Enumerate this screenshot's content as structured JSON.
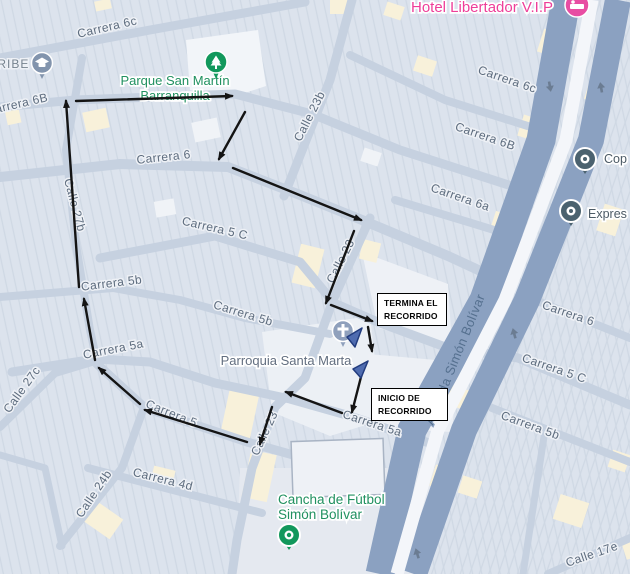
{
  "map": {
    "width": 630,
    "height": 574,
    "palette": {
      "bg_blocks": "#dce3ed",
      "block_stripe": "#cfd8e4",
      "street": "#c6d1e0",
      "avenue": "#8ba1c1",
      "avenue_median": "#f4f6fa",
      "street_label": "#5d6c7e",
      "avenue_label": "#55708f",
      "poi_green": "#219160",
      "poi_gray": "#636f80",
      "poi_pink": "#ee3e99",
      "poi_dark": "#4d5b66",
      "pin_green": "#12985c",
      "pin_slate": "#8294ad",
      "pin_church": "#8fa0bc",
      "pin_dark": "#4b626f",
      "pin_pink": "#e84da3",
      "route_color": "#141414",
      "marker_blue": "#4f6cb0",
      "marker_blue_dark": "#223c7e",
      "oneway": "#6b7c92"
    },
    "streets": [
      {
        "name": "carrera-6c",
        "w": 9,
        "pts": [
          [
            0,
            58
          ],
          [
            150,
            30
          ],
          [
            305,
            2
          ]
        ]
      },
      {
        "name": "carrera-6b",
        "w": 9,
        "pts": [
          [
            0,
            107
          ],
          [
            75,
            100
          ],
          [
            235,
            94
          ],
          [
            312,
            114
          ],
          [
            400,
            150
          ],
          [
            518,
            188
          ]
        ]
      },
      {
        "name": "carrera-6",
        "w": 10,
        "pts": [
          [
            0,
            177
          ],
          [
            120,
            164
          ],
          [
            228,
            167
          ],
          [
            300,
            195
          ],
          [
            362,
            220
          ],
          [
            448,
            256
          ],
          [
            500,
            280
          ]
        ]
      },
      {
        "name": "carrera-5c",
        "w": 9,
        "pts": [
          [
            100,
            258
          ],
          [
            215,
            236
          ],
          [
            300,
            262
          ],
          [
            334,
            303
          ],
          [
            380,
            323
          ],
          [
            448,
            348
          ],
          [
            518,
            358
          ],
          [
            630,
            405
          ]
        ]
      },
      {
        "name": "carrera-5b",
        "w": 8,
        "pts": [
          [
            0,
            297
          ],
          [
            113,
            288
          ],
          [
            180,
            300
          ],
          [
            245,
            318
          ],
          [
            330,
            334
          ]
        ]
      },
      {
        "name": "carrera-5a",
        "w": 9,
        "pts": [
          [
            12,
            372
          ],
          [
            95,
            359
          ],
          [
            150,
            362
          ],
          [
            215,
            383
          ],
          [
            290,
            399
          ],
          [
            350,
            416
          ],
          [
            432,
            444
          ]
        ]
      },
      {
        "name": "carrera-5",
        "w": 9,
        "pts": [
          [
            97,
            364
          ],
          [
            145,
            408
          ],
          [
            247,
            442
          ],
          [
            318,
            462
          ]
        ]
      },
      {
        "name": "carrera-4d",
        "w": 8,
        "pts": [
          [
            88,
            468
          ],
          [
            200,
            497
          ],
          [
            262,
            513
          ]
        ]
      },
      {
        "name": "calle-27b",
        "w": 8,
        "pts": [
          [
            82,
            58
          ],
          [
            66,
            150
          ],
          [
            76,
            245
          ],
          [
            90,
            330
          ],
          [
            97,
            362
          ]
        ]
      },
      {
        "name": "calle-27c",
        "w": 8,
        "pts": [
          [
            0,
            427
          ],
          [
            55,
            373
          ],
          [
            95,
            361
          ]
        ]
      },
      {
        "name": "calle-24b",
        "w": 8,
        "pts": [
          [
            60,
            546
          ],
          [
            122,
            468
          ],
          [
            143,
            410
          ]
        ]
      },
      {
        "name": "calle-24b-curve",
        "w": 7,
        "pts": [
          [
            0,
            455
          ],
          [
            45,
            468
          ],
          [
            62,
            546
          ]
        ]
      },
      {
        "name": "calle-23",
        "w": 9,
        "pts": [
          [
            370,
            218
          ],
          [
            333,
            300
          ],
          [
            305,
            378
          ],
          [
            275,
            407
          ],
          [
            252,
            468
          ],
          [
            237,
            540
          ],
          [
            232,
            574
          ]
        ]
      },
      {
        "name": "calle-23b",
        "w": 9,
        "pts": [
          [
            284,
            196
          ],
          [
            330,
            80
          ],
          [
            352,
            0
          ]
        ]
      },
      {
        "name": "carrera-6c-east",
        "w": 8,
        "pts": [
          [
            350,
            55
          ],
          [
            445,
            100
          ],
          [
            534,
            128
          ]
        ]
      },
      {
        "name": "carrera-6a",
        "w": 8,
        "pts": [
          [
            395,
            200
          ],
          [
            468,
            222
          ],
          [
            520,
            238
          ]
        ]
      },
      {
        "name": "carrera-6-east",
        "w": 8,
        "pts": [
          [
            535,
            300
          ],
          [
            630,
            338
          ]
        ]
      },
      {
        "name": "carrera-5b-east",
        "w": 8,
        "pts": [
          [
            492,
            408
          ],
          [
            630,
            462
          ]
        ]
      },
      {
        "name": "calle-17e",
        "w": 8,
        "pts": [
          [
            548,
            574
          ],
          [
            630,
            538
          ]
        ]
      },
      {
        "name": "calle-east",
        "w": 7,
        "pts": [
          [
            545,
            430
          ],
          [
            523,
            574
          ]
        ]
      }
    ],
    "avenue": {
      "name": "avenida-simon-bolivar",
      "carriageway_west": [
        [
          566,
          0
        ],
        [
          541,
          140
        ],
        [
          484,
          300
        ],
        [
          412,
          430
        ],
        [
          380,
          574
        ]
      ],
      "carriageway_east": [
        [
          618,
          0
        ],
        [
          591,
          140
        ],
        [
          527,
          300
        ],
        [
          464,
          430
        ],
        [
          414,
          574
        ]
      ],
      "median": [
        [
          592,
          0
        ],
        [
          566,
          140
        ],
        [
          505,
          300
        ],
        [
          438,
          430
        ],
        [
          397,
          574
        ]
      ]
    },
    "oneway_arrows": [
      [
        550,
        87,
        170
      ],
      [
        601,
        87,
        -10
      ],
      [
        514,
        333,
        -15
      ],
      [
        417,
        553,
        -17
      ]
    ],
    "plazas": [
      {
        "name": "park-area",
        "points": "186,40 258,30 266,86 230,98 190,90",
        "fill": "#f2f5f9"
      },
      {
        "name": "church-plaza",
        "points": "262,332 370,316 382,420 330,436 272,412",
        "fill": "#ecf0f5"
      },
      {
        "name": "block-termina",
        "points": "362,252 448,284 452,348 378,328",
        "fill": "#eef1f6"
      },
      {
        "name": "block-inicio",
        "points": "368,354 458,362 452,432 372,428",
        "fill": "#edf0f5"
      },
      {
        "name": "cancha-field",
        "points": "240,468 436,468 420,574 236,574",
        "fill": "#e5e9f0"
      }
    ],
    "big_building": {
      "x": 292,
      "y": 440,
      "w": 92,
      "h": 56,
      "rot": -2,
      "fill": "#eef1f6",
      "stroke": "#a9b4c4"
    },
    "cream_blocks": [
      [
        84,
        110,
        24,
        20,
        -12
      ],
      [
        6,
        108,
        14,
        16,
        -12
      ],
      [
        330,
        0,
        22,
        14,
        0
      ],
      [
        296,
        246,
        24,
        40,
        14
      ],
      [
        361,
        241,
        18,
        20,
        14
      ],
      [
        225,
        386,
        30,
        54,
        12
      ],
      [
        246,
        452,
        26,
        48,
        12
      ],
      [
        88,
        498,
        24,
        40,
        -55
      ],
      [
        152,
        468,
        22,
        16,
        14
      ],
      [
        385,
        4,
        18,
        14,
        18
      ],
      [
        415,
        58,
        20,
        16,
        18
      ],
      [
        95,
        0,
        16,
        10,
        -12
      ],
      [
        540,
        32,
        26,
        24,
        18
      ],
      [
        586,
        86,
        18,
        16,
        18
      ],
      [
        520,
        118,
        26,
        22,
        18
      ],
      [
        600,
        206,
        20,
        28,
        18
      ],
      [
        492,
        214,
        24,
        22,
        18
      ],
      [
        466,
        308,
        22,
        20,
        18
      ],
      [
        448,
        388,
        24,
        20,
        18
      ],
      [
        432,
        468,
        26,
        22,
        18
      ],
      [
        556,
        498,
        30,
        26,
        18
      ],
      [
        610,
        452,
        18,
        18,
        18
      ],
      [
        624,
        542,
        14,
        16,
        -18
      ],
      [
        460,
        478,
        20,
        18,
        18
      ]
    ],
    "white_blocks": [
      [
        193,
        120,
        26,
        20,
        -12
      ],
      [
        155,
        200,
        20,
        16,
        -10
      ],
      [
        362,
        150,
        18,
        14,
        18
      ]
    ],
    "street_labels": [
      {
        "text": "Carrera 6c",
        "x": 108,
        "y": 31,
        "rot": -13
      },
      {
        "text": "CARIBE",
        "x": 4,
        "y": 68,
        "rot": 0,
        "color": "#76838f",
        "spacing": 1
      },
      {
        "text": "Carrera 6B",
        "x": 18,
        "y": 108,
        "rot": -13
      },
      {
        "text": "Carrera 6",
        "x": 164,
        "y": 161,
        "rot": -6
      },
      {
        "text": "Calle 27b",
        "x": 71,
        "y": 206,
        "rot": 75
      },
      {
        "text": "Carrera 5 C",
        "x": 214,
        "y": 232,
        "rot": 13
      },
      {
        "text": "Carrera 5b",
        "x": 112,
        "y": 287,
        "rot": -7
      },
      {
        "text": "Carrera 5b",
        "x": 242,
        "y": 317,
        "rot": 17
      },
      {
        "text": "Carrera 5a",
        "x": 114,
        "y": 353,
        "rot": -11
      },
      {
        "text": "Calle 27c",
        "x": 25,
        "y": 392,
        "rot": -54
      },
      {
        "text": "Carrera 5",
        "x": 170,
        "y": 417,
        "rot": 22
      },
      {
        "text": "Carrera 5a",
        "x": 371,
        "y": 427,
        "rot": 18
      },
      {
        "text": "Calle 24b",
        "x": 97,
        "y": 496,
        "rot": -56
      },
      {
        "text": "Carrera 4d",
        "x": 162,
        "y": 483,
        "rot": 14
      },
      {
        "text": "Calle 23",
        "x": 268,
        "y": 435,
        "rot": -65
      },
      {
        "text": "Calle 23",
        "x": 344,
        "y": 263,
        "rot": -63
      },
      {
        "text": "Calle 23b",
        "x": 313,
        "y": 118,
        "rot": -63
      },
      {
        "text": "Carrera 6c",
        "x": 506,
        "y": 83,
        "rot": 19
      },
      {
        "text": "Carrera 6B",
        "x": 484,
        "y": 140,
        "rot": 19
      },
      {
        "text": "Carrera 6a",
        "x": 459,
        "y": 201,
        "rot": 19
      },
      {
        "text": "Carrera 6",
        "x": 567,
        "y": 317,
        "rot": 19
      },
      {
        "text": "Carrera 5 C",
        "x": 553,
        "y": 372,
        "rot": 19
      },
      {
        "text": "Carrera 5b",
        "x": 529,
        "y": 429,
        "rot": 20
      },
      {
        "text": "Calle 17e",
        "x": 593,
        "y": 558,
        "rot": -19
      },
      {
        "text": "Avenida Simón Bolívar",
        "x": 459,
        "y": 361,
        "rot": -68,
        "kind": "avenue"
      }
    ],
    "poi_labels": [
      {
        "name": "parque-san-martin",
        "lines": [
          "Parque San Martín",
          "Barranquilla"
        ],
        "x": 175,
        "y": 85,
        "lh": 15,
        "size": 13,
        "color": "#219160",
        "anchor": "middle"
      },
      {
        "name": "parroquia-santa-marta",
        "lines": [
          "Parroquia Santa Marta"
        ],
        "x": 286,
        "y": 365,
        "lh": 15,
        "size": 13,
        "color": "#636f80",
        "anchor": "middle"
      },
      {
        "name": "cancha-de-futbol",
        "lines": [
          "Cancha de Fútbol",
          "Simón Bolívar"
        ],
        "x": 278,
        "y": 504,
        "lh": 15,
        "size": 13.5,
        "color": "#219160",
        "anchor": "start"
      },
      {
        "name": "hotel-libertador",
        "lines": [
          "Hotel Libertador V.I.P"
        ],
        "x": 482,
        "y": 12,
        "lh": 15,
        "size": 15,
        "color": "#ee3e99",
        "anchor": "middle"
      },
      {
        "name": "cop",
        "lines": [
          "Cop"
        ],
        "x": 604,
        "y": 163,
        "lh": 14,
        "size": 12.5,
        "color": "#4d5b66",
        "anchor": "start"
      },
      {
        "name": "expres",
        "lines": [
          "Expres"
        ],
        "x": 588,
        "y": 218,
        "lh": 14,
        "size": 12.5,
        "color": "#4d5b66",
        "anchor": "start"
      }
    ],
    "pins": [
      {
        "type": "education",
        "x": 42,
        "y": 63
      },
      {
        "type": "park",
        "x": 216,
        "y": 62
      },
      {
        "type": "hotel",
        "x": 577,
        "y": 5
      },
      {
        "type": "church",
        "x": 343,
        "y": 331
      },
      {
        "type": "transit",
        "x": 585,
        "y": 159
      },
      {
        "type": "transit",
        "x": 571,
        "y": 211
      },
      {
        "type": "sports",
        "x": 289,
        "y": 535
      }
    ],
    "route": {
      "segments": [
        [
          95,
          360,
          84,
          299
        ],
        [
          79,
          287,
          66,
          101
        ],
        [
          76,
          101,
          232,
          96
        ],
        [
          245,
          112,
          219,
          159
        ],
        [
          233,
          168,
          361,
          220
        ],
        [
          354,
          231,
          326,
          303
        ],
        [
          331,
          305,
          372,
          321
        ],
        [
          368,
          327,
          372,
          351
        ],
        [
          362,
          373,
          352,
          412
        ],
        [
          342,
          413,
          286,
          392
        ],
        [
          272,
          407,
          260,
          444
        ],
        [
          247,
          442,
          145,
          410
        ],
        [
          140,
          404,
          99,
          368
        ]
      ]
    },
    "route_markers": [
      {
        "points": "362,328 347,337 355,347"
      },
      {
        "points": "368,361 353,369 361,378"
      }
    ],
    "callouts": {
      "termina": {
        "line1": "TERMINA EL",
        "line2": "RECORRIDO",
        "x": 377,
        "y": 293,
        "w": 70,
        "h": 33
      },
      "inicio": {
        "line1": "INICIO DE",
        "line2": "RECORRIDO",
        "x": 371,
        "y": 388,
        "w": 77,
        "h": 33
      }
    }
  }
}
